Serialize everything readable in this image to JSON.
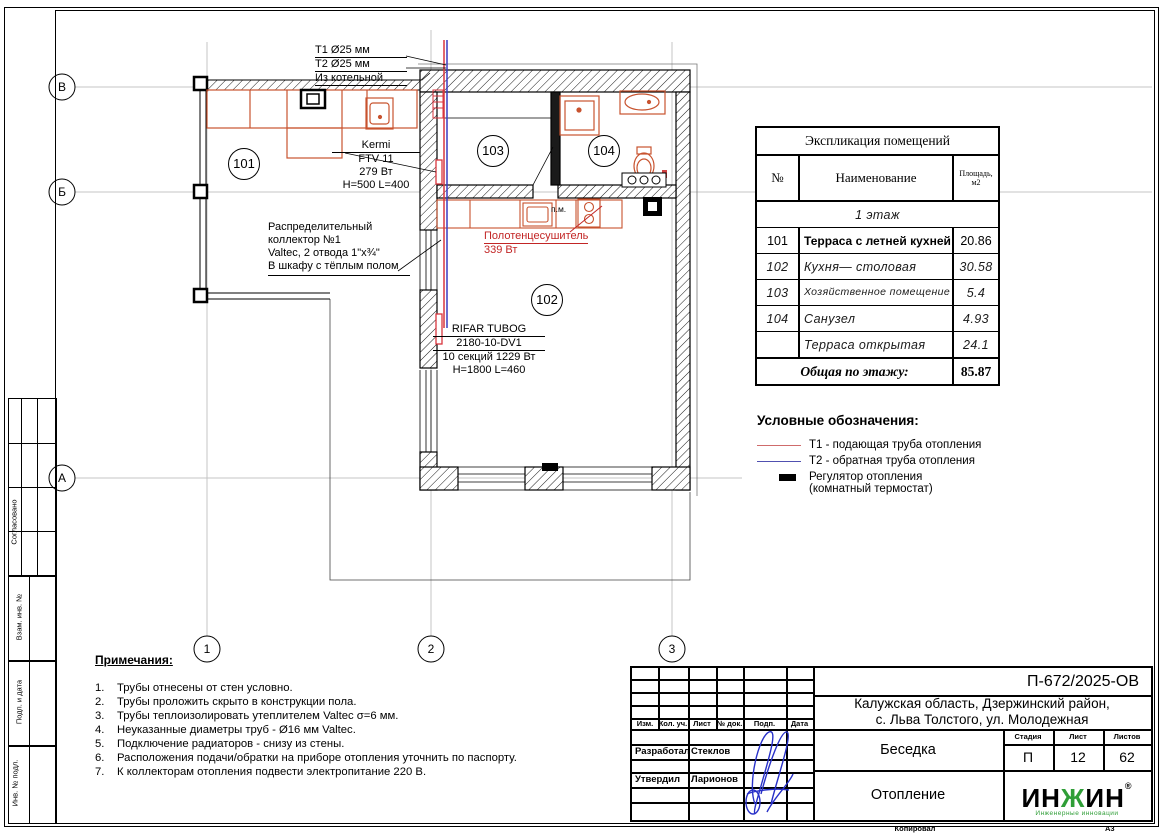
{
  "sheet": {
    "copied_label": "Копировал",
    "format_label": "А3"
  },
  "frame_labels": {
    "agreed": "Согласовано",
    "vzam": "Взам. инв. №",
    "podp": "Подп. и дата",
    "inv": "Инв. № подл."
  },
  "axes": {
    "row_b": "В",
    "row_bb": "Б",
    "row_a": "А",
    "col_1": "1",
    "col_2": "2",
    "col_3": "3"
  },
  "plan": {
    "supply_label": "Т1 Ø25 мм",
    "return_label": "Т2 Ø25 мм",
    "from_boiler": "Из котельной",
    "kermi": {
      "l1": "Kermi",
      "l2": "FTV 11",
      "l3": "279 Вт",
      "l4": "H=500 L=400"
    },
    "collector": {
      "l1": "Распределительный",
      "l2": "коллектор №1",
      "l3": "Valtec, 2 отвода 1\"х¾\"",
      "l4": "В шкафу с тёплым полом"
    },
    "towel": {
      "l1": "Полотенцесушитель",
      "l2": "339 Вт"
    },
    "rifar": {
      "l1": "RIFAR TUBOG",
      "l2": "2180-10-DV1",
      "l3": "10 секций 1229 Вт",
      "l4": "H=1800 L=460"
    },
    "pm": "п.м.",
    "rooms": {
      "r101": "101",
      "r102": "102",
      "r103": "103",
      "r104": "104"
    },
    "pipe_supply_color": "#d8363e",
    "pipe_return_color": "#3c3cc0",
    "fixture_color": "#c8532f"
  },
  "explication": {
    "title": "Экспликация помещений",
    "col_no": "№",
    "col_name": "Наименование",
    "col_area_1": "Площадь,",
    "col_area_2": "м2",
    "floor_row": "1  этаж",
    "rows": [
      {
        "no": "101",
        "name": "Терраса с летней кухней",
        "area": "20.86"
      },
      {
        "no": "102",
        "name": "Кухня— столовая",
        "area": "30.58"
      },
      {
        "no": "103",
        "name": "Хозяйственное помещение",
        "area": "5.4"
      },
      {
        "no": "104",
        "name": "Санузел",
        "area": "4.93"
      },
      {
        "no": "",
        "name": "Терраса  открытая",
        "area": "24.1"
      }
    ],
    "total_label": "Общая по этажу:",
    "total_value": "85.87"
  },
  "legend": {
    "title": "Условные обозначения:",
    "t1": "Т1 - подающая труба отопления",
    "t2": "Т2 - обратная труба отопления",
    "reg1": "Регулятор отопления",
    "reg2": "(комнатный термостат)",
    "t1_color": "#cf6b6b",
    "t2_color": "#5050b0"
  },
  "notes": {
    "title": "Примечания:",
    "items": [
      {
        "n": "1.",
        "text": "Трубы отнесены от стен условно."
      },
      {
        "n": "2.",
        "text": "Трубы проложить скрыто в конструкции пола."
      },
      {
        "n": "3.",
        "text": "Трубы теплоизолировать утеплителем Valtec σ=6 мм."
      },
      {
        "n": "4.",
        "text": "Неуказанные диаметры труб - Ø16 мм Valtec."
      },
      {
        "n": "5.",
        "text": "Подключение радиаторов - снизу из стены."
      },
      {
        "n": "6.",
        "text": "Расположения подачи/обратки на приборе отопления уточнить по паспорту."
      },
      {
        "n": "7.",
        "text": "К коллекторам отопления подвести электропитание 220 В."
      }
    ]
  },
  "titleblock": {
    "doc_number": "П-672/2025-ОВ",
    "address1": "Калужская область, Дзержинский район,",
    "address2": "с. Льва Толстого, ул. Молодежная",
    "cols": {
      "izm": "Изм.",
      "kol": "Кол. уч.",
      "list": "Лист",
      "dok": "№ док.",
      "podp": "Подп.",
      "data": "Дата"
    },
    "developed_label": "Разработал",
    "developed_name": "Стеклов",
    "approved_label": "Утвердил",
    "approved_name": "Ларионов",
    "object_name": "Беседка",
    "stage_label": "Стадия",
    "stage_value": "П",
    "sheet_label": "Лист",
    "sheet_value": "12",
    "sheets_label": "Листов",
    "sheets_value": "62",
    "section_name": "Отопление",
    "logo": {
      "part1": "ИН",
      "part2": "Ж",
      "part3": "ИН",
      "reg": "®",
      "tagline": "Инженерные инновации",
      "green": "#2f9e37"
    }
  }
}
